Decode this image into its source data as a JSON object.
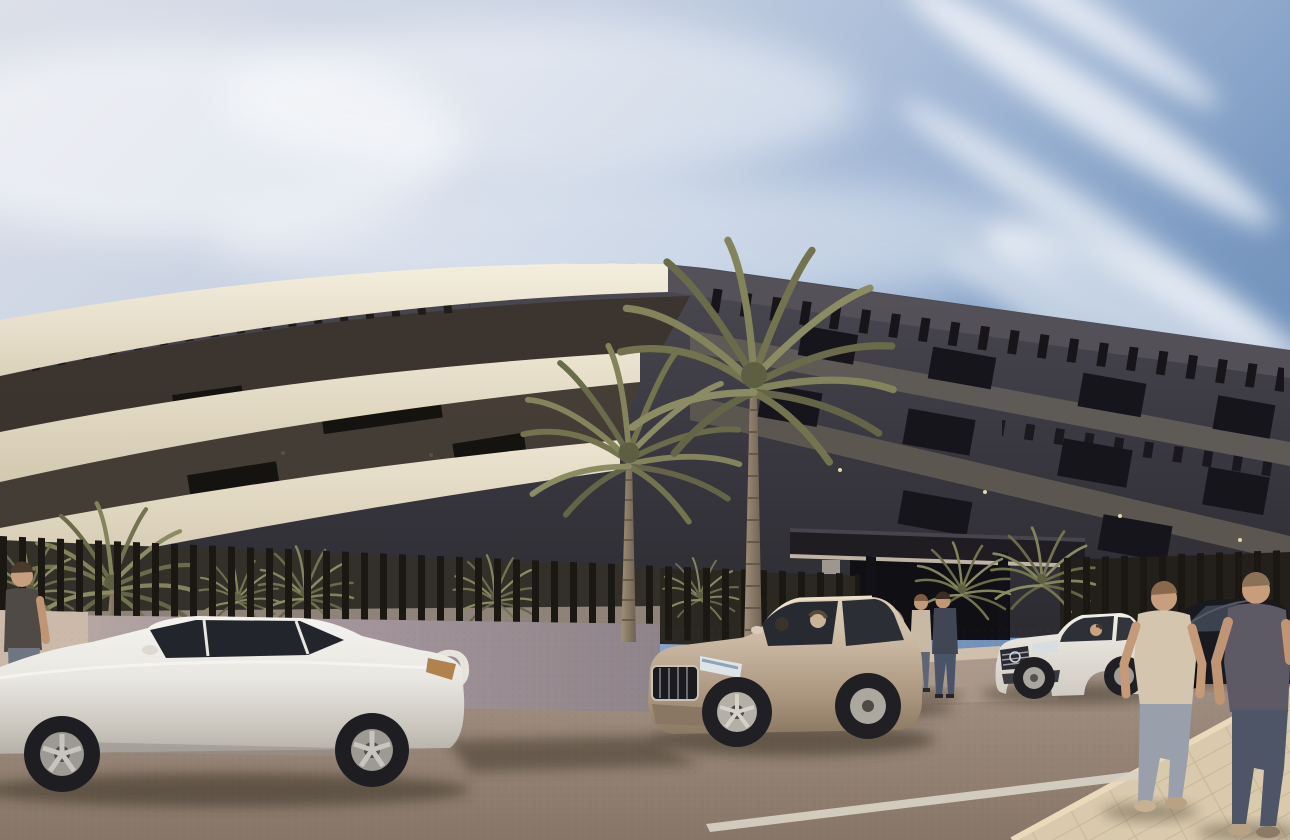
{
  "image": {
    "width": 1290,
    "height": 840,
    "kind": "architectural-exterior-render"
  },
  "wall_sign": {
    "text": "TO"
  },
  "scene": {
    "setting": "sunny-day curved three-storey apartment building with roof pergolas",
    "vehicles": [
      "white-sedan-foreground",
      "champagne-suv-center",
      "beige-suv-at-entrance",
      "white-mercedes-sedan",
      "black-sedan-background"
    ],
    "people": [
      "man-standing-left-edge",
      "two-people-at-entrance",
      "driver-in-white-sedan",
      "two-men-walking-right"
    ],
    "vegetation": [
      "two-tall-palm-trees",
      "palm-shrubs-behind-fence"
    ],
    "signage": "partial white capital letters on perimeter wall"
  },
  "palette": {
    "sky_top": "#dde0e9",
    "sky_deep": "#6f90ba",
    "facade_cream": "#eee6d3",
    "facade_shadow": "#3a3840",
    "pergola": "#1b1916",
    "fence_slats": "#1b1713",
    "perimeter_wall": "#a2949a",
    "road": "#9b897c",
    "sidewalk": "#d9c9ad",
    "palm_green": "#7b7c59",
    "car_white": "#eceae4",
    "car_champagne": "#c5b29c"
  }
}
